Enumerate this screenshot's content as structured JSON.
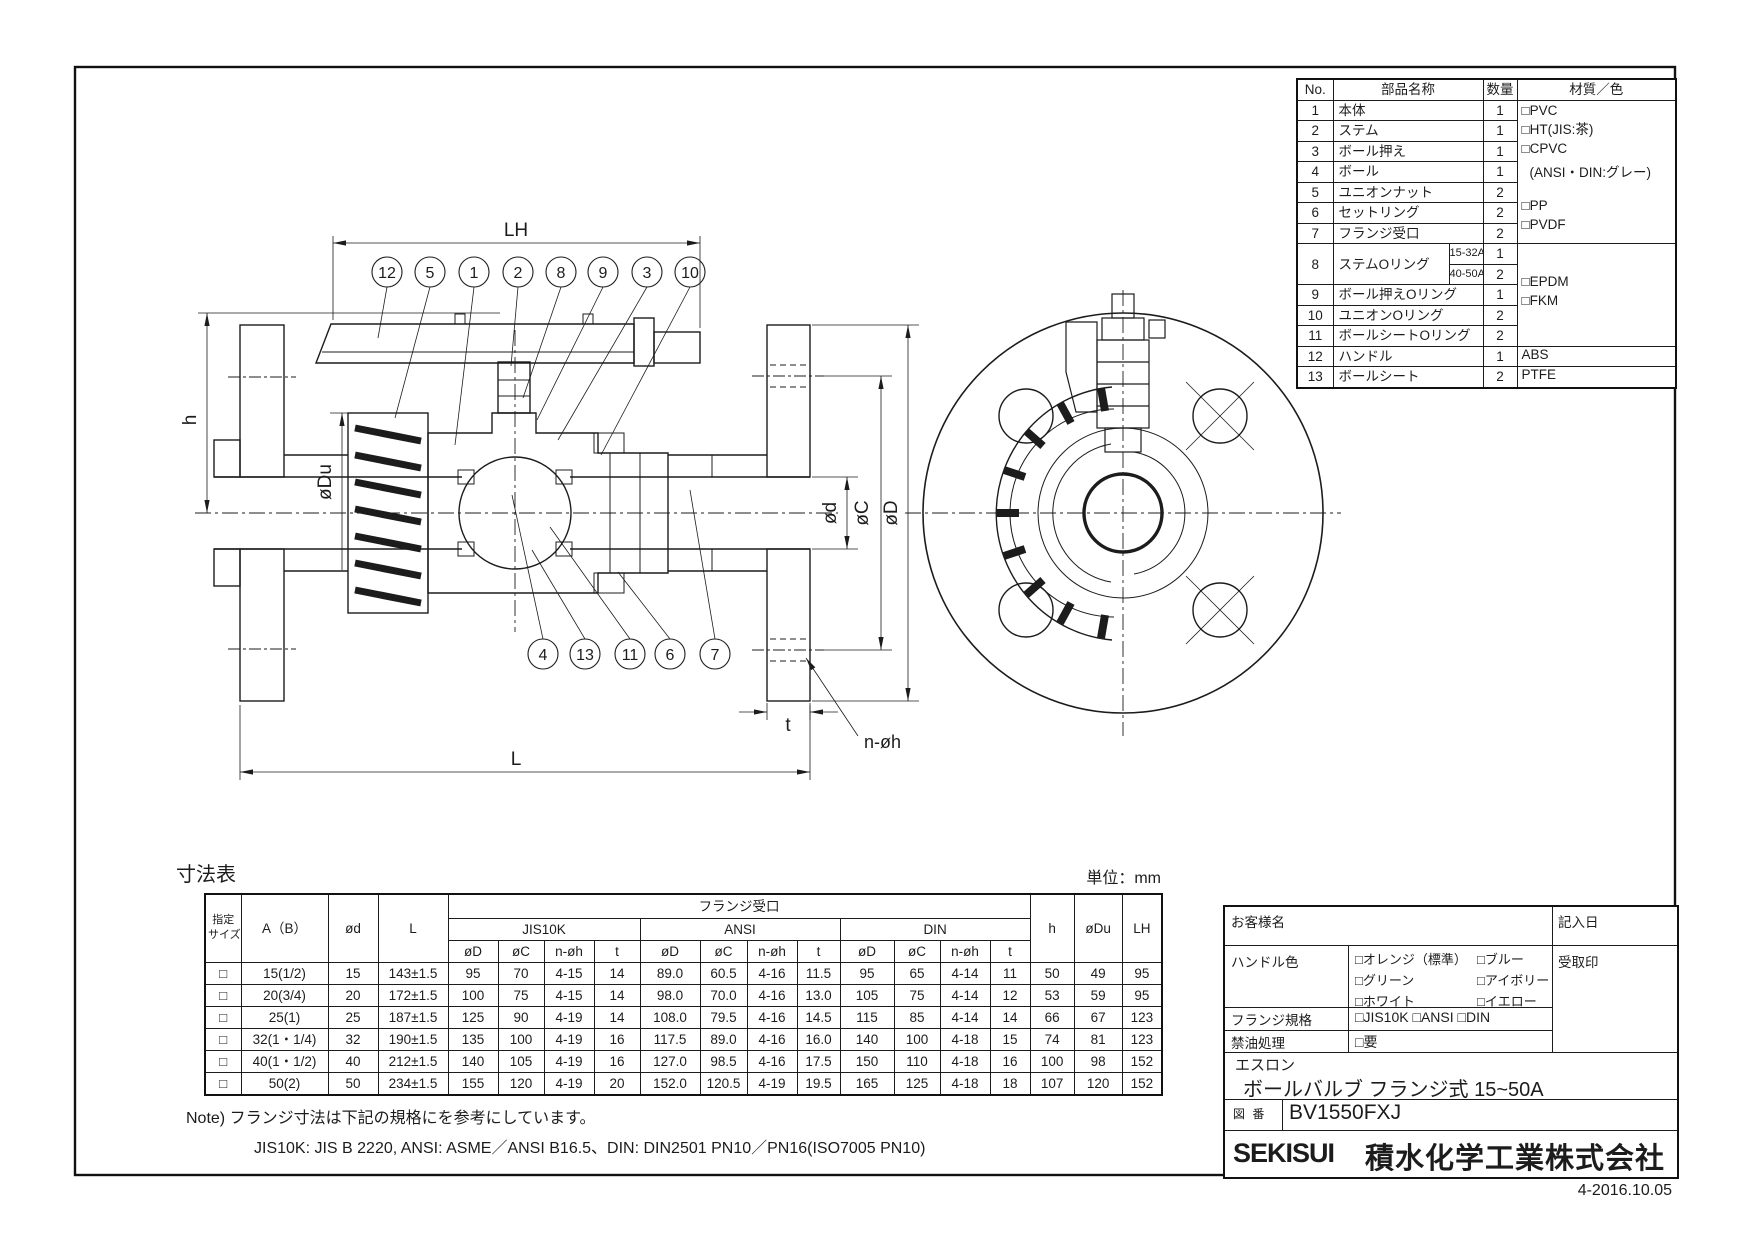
{
  "page": {
    "date_code": "4-2016.10.05"
  },
  "parts_table": {
    "headers": {
      "no": "No.",
      "name": "部品名称",
      "qty": "数量",
      "material": "材質／色"
    },
    "rows": [
      {
        "no": "1",
        "name": "本体",
        "qty": "1"
      },
      {
        "no": "2",
        "name": "ステム",
        "qty": "1"
      },
      {
        "no": "3",
        "name": "ボール押え",
        "qty": "1"
      },
      {
        "no": "4",
        "name": "ボール",
        "qty": "1"
      },
      {
        "no": "5",
        "name": "ユニオンナット",
        "qty": "2"
      },
      {
        "no": "6",
        "name": "セットリング",
        "qty": "2"
      },
      {
        "no": "7",
        "name": "フランジ受口",
        "qty": "2"
      },
      {
        "no": "8",
        "name": "ステムOリング",
        "range1": "15-32A",
        "qty1": "1",
        "range2": "40-50A",
        "qty2": "2"
      },
      {
        "no": "9",
        "name": "ボール押えOリング",
        "qty": "1"
      },
      {
        "no": "10",
        "name": "ユニオンOリング",
        "qty": "2"
      },
      {
        "no": "11",
        "name": "ボールシートOリング",
        "qty": "2"
      },
      {
        "no": "12",
        "name": "ハンドル",
        "qty": "1",
        "material": "ABS"
      },
      {
        "no": "13",
        "name": "ボールシート",
        "qty": "2",
        "material": "PTFE"
      }
    ],
    "material_group_a": [
      "□PVC",
      "□HT(JIS:茶)",
      "□CPVC",
      "(ANSI・DIN:グレー)",
      "□PP",
      "□PVDF"
    ],
    "material_group_b": [
      "□EPDM",
      "□FKM"
    ]
  },
  "dim_table": {
    "title": "寸法表",
    "unit": "単位：mm",
    "headers": {
      "size_l1": "指定",
      "size_l2": "サイズ",
      "ab": "A（B）",
      "od": "ød",
      "l": "L",
      "flange": "フランジ受口",
      "jis": "JIS10K",
      "ansi": "ANSI",
      "din": "DIN",
      "d": "øD",
      "c": "øC",
      "noh": "n-øh",
      "t": "t",
      "h": "h",
      "du": "øDu",
      "lh": "LH"
    },
    "rows": [
      {
        "chk": "□",
        "ab": "15(1/2)",
        "od": "15",
        "l": "143±1.5",
        "jis": [
          "95",
          "70",
          "4-15",
          "14"
        ],
        "ansi": [
          "89.0",
          "60.5",
          "4-16",
          "11.5"
        ],
        "din": [
          "95",
          "65",
          "4-14",
          "11"
        ],
        "h": "50",
        "du": "49",
        "lh": "95"
      },
      {
        "chk": "□",
        "ab": "20(3/4)",
        "od": "20",
        "l": "172±1.5",
        "jis": [
          "100",
          "75",
          "4-15",
          "14"
        ],
        "ansi": [
          "98.0",
          "70.0",
          "4-16",
          "13.0"
        ],
        "din": [
          "105",
          "75",
          "4-14",
          "12"
        ],
        "h": "53",
        "du": "59",
        "lh": "95"
      },
      {
        "chk": "□",
        "ab": "25(1)",
        "od": "25",
        "l": "187±1.5",
        "jis": [
          "125",
          "90",
          "4-19",
          "14"
        ],
        "ansi": [
          "108.0",
          "79.5",
          "4-16",
          "14.5"
        ],
        "din": [
          "115",
          "85",
          "4-14",
          "14"
        ],
        "h": "66",
        "du": "67",
        "lh": "123"
      },
      {
        "chk": "□",
        "ab": "32(1・1/4)",
        "od": "32",
        "l": "190±1.5",
        "jis": [
          "135",
          "100",
          "4-19",
          "16"
        ],
        "ansi": [
          "117.5",
          "89.0",
          "4-16",
          "16.0"
        ],
        "din": [
          "140",
          "100",
          "4-18",
          "15"
        ],
        "h": "74",
        "du": "81",
        "lh": "123"
      },
      {
        "chk": "□",
        "ab": "40(1・1/2)",
        "od": "40",
        "l": "212±1.5",
        "jis": [
          "140",
          "105",
          "4-19",
          "16"
        ],
        "ansi": [
          "127.0",
          "98.5",
          "4-16",
          "17.5"
        ],
        "din": [
          "150",
          "110",
          "4-18",
          "16"
        ],
        "h": "100",
        "du": "98",
        "lh": "152"
      },
      {
        "chk": "□",
        "ab": "50(2)",
        "od": "50",
        "l": "234±1.5",
        "jis": [
          "155",
          "120",
          "4-19",
          "20"
        ],
        "ansi": [
          "152.0",
          "120.5",
          "4-19",
          "19.5"
        ],
        "din": [
          "165",
          "125",
          "4-18",
          "18"
        ],
        "h": "107",
        "du": "120",
        "lh": "152"
      }
    ]
  },
  "notes": {
    "line1": "Note) フランジ寸法は下記の規格にを参考にしています。",
    "line2": "JIS10K: JIS B 2220, ANSI: ASME／ANSI B16.5、DIN: DIN2501 PN10／PN16(ISO7005 PN10)"
  },
  "title_block": {
    "customer_label": "お客様名",
    "date_label": "記入日",
    "handle_color_label": "ハンドル色",
    "handle_colors_l": [
      "□オレンジ（標準）",
      "□グリーン",
      "□ホワイト"
    ],
    "handle_colors_r": [
      "□ブルー",
      "□アイボリー",
      "□イエロー"
    ],
    "receipt_label": "受取印",
    "flange_std_label": "フランジ規格",
    "flange_std_options": "□JIS10K  □ANSI  □DIN",
    "oil_free_label": "禁油処理",
    "oil_free_option": "□要",
    "brand": "エスロン",
    "product": "ボールバルブ フランジ式 15~50A",
    "drawing_no_label": "図 番",
    "drawing_no": "BV1550FXJ",
    "logo": "SEKISUI",
    "company": "積水化学工業株式会社"
  },
  "drawing": {
    "balloons_top": [
      "12",
      "5",
      "1",
      "2",
      "8",
      "9",
      "3",
      "10"
    ],
    "balloons_bottom": [
      "4",
      "13",
      "11",
      "6",
      "7"
    ],
    "dims": {
      "lh": "LH",
      "h": "h",
      "du": "øDu",
      "d_small": "ød",
      "c": "øC",
      "d": "øD",
      "t": "t",
      "l": "L",
      "noh": "n-øh"
    }
  }
}
